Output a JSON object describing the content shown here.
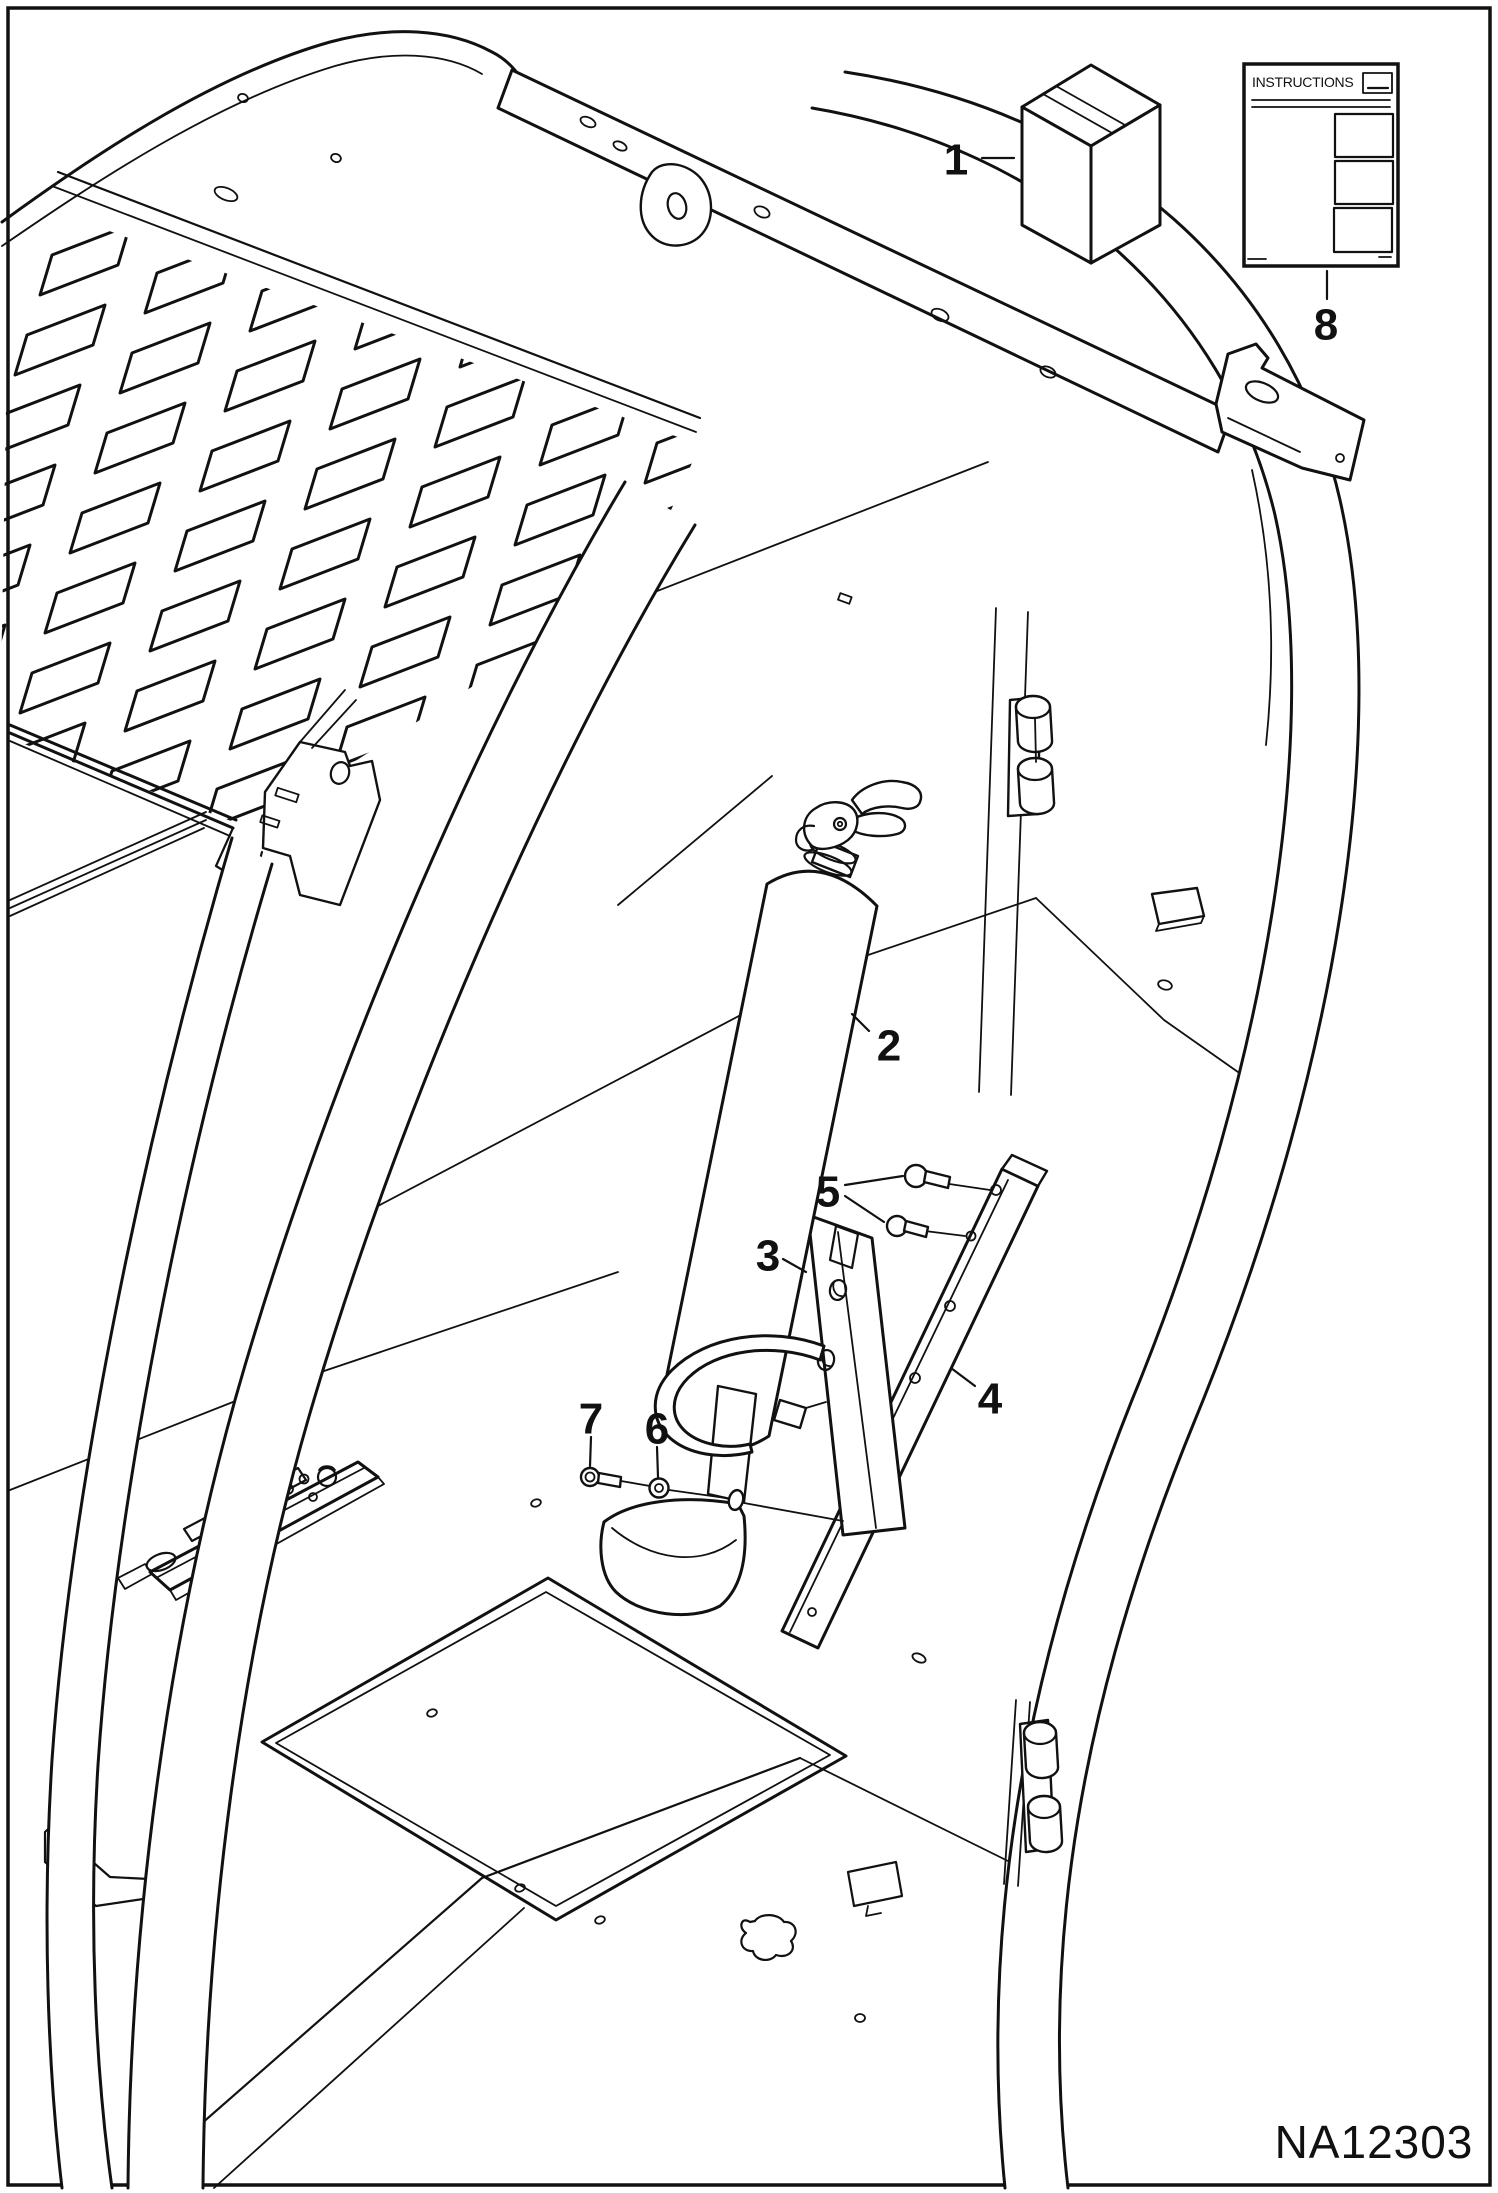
{
  "diagram": {
    "drawing_number": "NA12303",
    "instruction_sheet": {
      "title": "INSTRUCTIONS"
    },
    "callouts": [
      {
        "label": "1"
      },
      {
        "label": "2"
      },
      {
        "label": "3"
      },
      {
        "label": "4"
      },
      {
        "label": "5"
      },
      {
        "label": "6"
      },
      {
        "label": "7"
      },
      {
        "label": "8"
      }
    ]
  }
}
